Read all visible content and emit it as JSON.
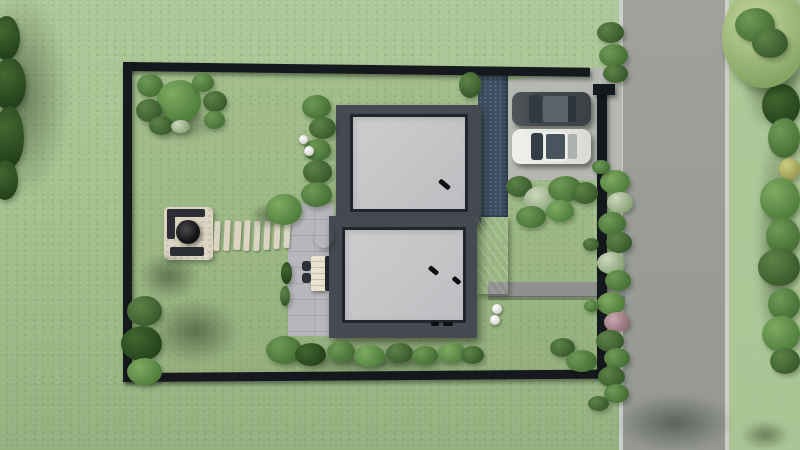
{
  "scene": {
    "type": "3d-architectural-render",
    "view": "top-down aerial site plan",
    "description": "Rectangular fenced plot with two flat-roof modern buildings, driveway with two parked cars, fire-pit lounge, stepping-stone path, patio with furniture, glass canopy, garden beds, and a gray road running along the right side",
    "buildings": [
      {
        "name": "upper-building",
        "roof": "flat light gray with dark parapet",
        "vents": 1
      },
      {
        "name": "lower-building",
        "roof": "flat light gray with dark parapet",
        "vents": 2
      }
    ],
    "cars": [
      {
        "name": "dark-gray-car",
        "facing": "west"
      },
      {
        "name": "white-car",
        "facing": "west"
      }
    ],
    "features": [
      "fire-pit-platform",
      "stepping-stone-path",
      "patio-with-furniture",
      "glass-canopy",
      "driveway",
      "garden-walk-path",
      "sphere-lamps",
      "perimeter-fence",
      "street"
    ]
  },
  "colors": {
    "grassBase": "#a4c18e",
    "grassLight": "#aec999",
    "grassDark": "#94b07f",
    "road": "#9b9d99",
    "curb": "#cdcfc9",
    "concrete": "#b6b8b4",
    "patio": "#b8b7bc",
    "roofFrame": "#454a52",
    "roofEdge": "#22262c",
    "fence": "#15181c",
    "stone": "#dbd4c3",
    "glass": "#506173",
    "bluepath": "#3d4f63",
    "pathGray": "#8f918e",
    "carDark": "#45494e",
    "carWhite": "#e8e9e5",
    "carGlass": "#2f3a45"
  },
  "vegetation": {
    "bushes": [
      {
        "x": 137,
        "y": 74,
        "w": 26,
        "h": 23,
        "v": "v2"
      },
      {
        "x": 157,
        "y": 80,
        "w": 44,
        "h": 42,
        "v": "v1"
      },
      {
        "x": 192,
        "y": 73,
        "w": 22,
        "h": 19,
        "v": "v2"
      },
      {
        "x": 203,
        "y": 91,
        "w": 24,
        "h": 21,
        "v": "v3"
      },
      {
        "x": 136,
        "y": 99,
        "w": 26,
        "h": 23,
        "v": "v3"
      },
      {
        "x": 204,
        "y": 111,
        "w": 21,
        "h": 18,
        "v": "v2"
      },
      {
        "x": 149,
        "y": 116,
        "w": 24,
        "h": 19,
        "v": "v3"
      },
      {
        "x": 171,
        "y": 120,
        "w": 19,
        "h": 13,
        "v": "wht"
      },
      {
        "x": 302,
        "y": 95,
        "w": 29,
        "h": 24,
        "v": "v2"
      },
      {
        "x": 309,
        "y": 117,
        "w": 27,
        "h": 22,
        "v": "v3"
      },
      {
        "x": 304,
        "y": 139,
        "w": 27,
        "h": 22,
        "v": "v2"
      },
      {
        "x": 303,
        "y": 160,
        "w": 29,
        "h": 24,
        "v": "v3"
      },
      {
        "x": 301,
        "y": 182,
        "w": 31,
        "h": 25,
        "v": "v2"
      },
      {
        "x": 266,
        "y": 194,
        "w": 36,
        "h": 31,
        "v": "v1"
      },
      {
        "x": 459,
        "y": 72,
        "w": 22,
        "h": 26,
        "v": "v3"
      },
      {
        "x": 281,
        "y": 262,
        "w": 11,
        "h": 22,
        "v": "v4"
      },
      {
        "x": 280,
        "y": 286,
        "w": 10,
        "h": 20,
        "v": "v3"
      },
      {
        "x": 506,
        "y": 176,
        "w": 26,
        "h": 21,
        "v": "v3"
      },
      {
        "x": 524,
        "y": 186,
        "w": 34,
        "h": 26,
        "v": "wht"
      },
      {
        "x": 548,
        "y": 176,
        "w": 34,
        "h": 26,
        "v": "v2"
      },
      {
        "x": 572,
        "y": 182,
        "w": 26,
        "h": 22,
        "v": "v3"
      },
      {
        "x": 516,
        "y": 206,
        "w": 30,
        "h": 22,
        "v": "v2"
      },
      {
        "x": 546,
        "y": 200,
        "w": 28,
        "h": 22,
        "v": "v1"
      },
      {
        "x": 600,
        "y": 170,
        "w": 30,
        "h": 24,
        "v": "v1"
      },
      {
        "x": 607,
        "y": 192,
        "w": 26,
        "h": 21,
        "v": "wht"
      },
      {
        "x": 598,
        "y": 212,
        "w": 28,
        "h": 23,
        "v": "v2"
      },
      {
        "x": 606,
        "y": 232,
        "w": 26,
        "h": 21,
        "v": "v3"
      },
      {
        "x": 597,
        "y": 252,
        "w": 28,
        "h": 22,
        "v": "wht"
      },
      {
        "x": 605,
        "y": 270,
        "w": 26,
        "h": 21,
        "v": "v2"
      },
      {
        "x": 597,
        "y": 292,
        "w": 28,
        "h": 23,
        "v": "v1"
      },
      {
        "x": 604,
        "y": 312,
        "w": 26,
        "h": 20,
        "v": "pnk"
      },
      {
        "x": 596,
        "y": 330,
        "w": 28,
        "h": 22,
        "v": "v3"
      },
      {
        "x": 604,
        "y": 348,
        "w": 26,
        "h": 20,
        "v": "v2"
      },
      {
        "x": 583,
        "y": 238,
        "w": 16,
        "h": 13,
        "v": "v3"
      },
      {
        "x": 584,
        "y": 300,
        "w": 15,
        "h": 12,
        "v": "v2"
      },
      {
        "x": 592,
        "y": 160,
        "w": 18,
        "h": 14,
        "v": "v2"
      },
      {
        "x": 266,
        "y": 336,
        "w": 36,
        "h": 28,
        "v": "v2"
      },
      {
        "x": 295,
        "y": 343,
        "w": 31,
        "h": 23,
        "v": "v4"
      },
      {
        "x": 327,
        "y": 341,
        "w": 28,
        "h": 21,
        "v": "v2"
      },
      {
        "x": 354,
        "y": 345,
        "w": 31,
        "h": 22,
        "v": "v1"
      },
      {
        "x": 386,
        "y": 343,
        "w": 27,
        "h": 20,
        "v": "v3"
      },
      {
        "x": 412,
        "y": 346,
        "w": 26,
        "h": 19,
        "v": "v2"
      },
      {
        "x": 438,
        "y": 343,
        "w": 28,
        "h": 20,
        "v": "v1"
      },
      {
        "x": 461,
        "y": 346,
        "w": 23,
        "h": 18,
        "v": "v3"
      },
      {
        "x": 550,
        "y": 338,
        "w": 25,
        "h": 19,
        "v": "v3"
      },
      {
        "x": 566,
        "y": 350,
        "w": 31,
        "h": 22,
        "v": "v2"
      },
      {
        "x": 127,
        "y": 296,
        "w": 35,
        "h": 30,
        "v": "v3"
      },
      {
        "x": 121,
        "y": 326,
        "w": 41,
        "h": 35,
        "v": "v4"
      },
      {
        "x": 127,
        "y": 358,
        "w": 35,
        "h": 27,
        "v": "v1"
      },
      {
        "x": 597,
        "y": 22,
        "w": 27,
        "h": 21,
        "v": "v3"
      },
      {
        "x": 599,
        "y": 44,
        "w": 29,
        "h": 23,
        "v": "v2"
      },
      {
        "x": 603,
        "y": 64,
        "w": 25,
        "h": 19,
        "v": "v3"
      },
      {
        "x": 598,
        "y": 366,
        "w": 27,
        "h": 21,
        "v": "v3"
      },
      {
        "x": 604,
        "y": 384,
        "w": 25,
        "h": 19,
        "v": "v2"
      },
      {
        "x": 588,
        "y": 396,
        "w": 21,
        "h": 15,
        "v": "v3"
      },
      {
        "x": 762,
        "y": 84,
        "w": 38,
        "h": 42,
        "v": "v4"
      },
      {
        "x": 768,
        "y": 118,
        "w": 32,
        "h": 40,
        "v": "v2"
      },
      {
        "x": 779,
        "y": 158,
        "w": 21,
        "h": 22,
        "v": "yel"
      },
      {
        "x": 760,
        "y": 178,
        "w": 40,
        "h": 42,
        "v": "v1"
      },
      {
        "x": 766,
        "y": 218,
        "w": 34,
        "h": 36,
        "v": "v2"
      },
      {
        "x": 758,
        "y": 248,
        "w": 42,
        "h": 38,
        "v": "v3"
      },
      {
        "x": 768,
        "y": 288,
        "w": 32,
        "h": 32,
        "v": "v2"
      },
      {
        "x": 762,
        "y": 316,
        "w": 38,
        "h": 36,
        "v": "v1"
      },
      {
        "x": 770,
        "y": 348,
        "w": 30,
        "h": 26,
        "v": "v3"
      },
      {
        "x": -8,
        "y": 16,
        "w": 28,
        "h": 44,
        "v": "v4"
      },
      {
        "x": -8,
        "y": 58,
        "w": 34,
        "h": 52,
        "v": "v4"
      },
      {
        "x": -6,
        "y": 106,
        "w": 30,
        "h": 62,
        "v": "v4"
      },
      {
        "x": -8,
        "y": 160,
        "w": 26,
        "h": 40,
        "v": "v4"
      },
      {
        "x": 722,
        "y": -14,
        "w": 84,
        "h": 102,
        "v": "tree"
      },
      {
        "x": 735,
        "y": 8,
        "w": 40,
        "h": 34,
        "v": "v2"
      },
      {
        "x": 752,
        "y": 28,
        "w": 36,
        "h": 30,
        "v": "v3"
      },
      {
        "x": 313,
        "y": 221,
        "w": 21,
        "h": 27,
        "v": "blu"
      }
    ],
    "lamps": [
      {
        "x": 299,
        "y": 135,
        "d": 9
      },
      {
        "x": 304,
        "y": 146,
        "d": 10
      },
      {
        "x": 492,
        "y": 304,
        "d": 10
      },
      {
        "x": 490,
        "y": 315,
        "d": 10
      }
    ],
    "stones": [
      {
        "x": 214,
        "y": 221,
        "w": 6,
        "h": 30
      },
      {
        "x": 224,
        "y": 220,
        "w": 6,
        "h": 31
      },
      {
        "x": 234,
        "y": 221,
        "w": 7,
        "h": 29
      },
      {
        "x": 244,
        "y": 220,
        "w": 6,
        "h": 31
      },
      {
        "x": 254,
        "y": 221,
        "w": 6,
        "h": 30
      },
      {
        "x": 264,
        "y": 221,
        "w": 6,
        "h": 29
      },
      {
        "x": 274,
        "y": 222,
        "w": 6,
        "h": 27
      },
      {
        "x": 284,
        "y": 223,
        "w": 6,
        "h": 25
      }
    ],
    "shadows": [
      {
        "x": -30,
        "y": -10,
        "w": 100,
        "h": 210
      },
      {
        "x": 140,
        "y": 104,
        "w": 80,
        "h": 38
      },
      {
        "x": 138,
        "y": 252,
        "w": 62,
        "h": 48
      },
      {
        "x": 150,
        "y": 298,
        "w": 90,
        "h": 66
      },
      {
        "x": 268,
        "y": 350,
        "w": 214,
        "h": 24
      },
      {
        "x": 744,
        "y": 46,
        "w": 62,
        "h": 88
      },
      {
        "x": 614,
        "y": 394,
        "w": 122,
        "h": 58
      },
      {
        "x": 250,
        "y": 202,
        "w": 38,
        "h": 28
      },
      {
        "x": 755,
        "y": 120,
        "w": 46,
        "h": 250
      },
      {
        "x": 740,
        "y": 420,
        "w": 50,
        "h": 30
      }
    ]
  }
}
